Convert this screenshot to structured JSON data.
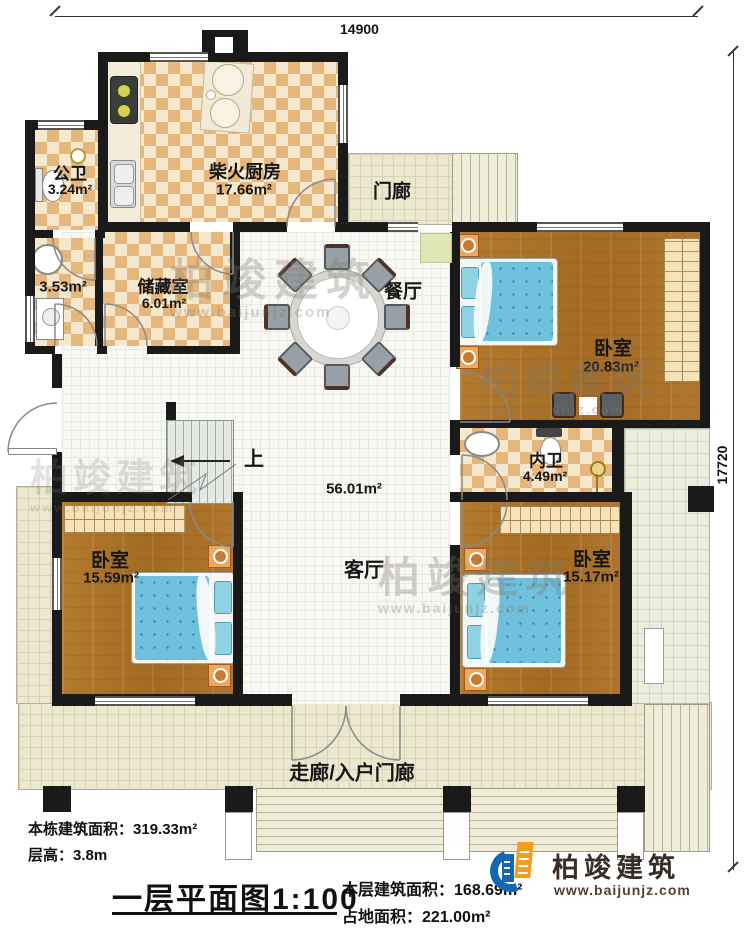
{
  "plan": {
    "dimensions": {
      "width_label": "14900",
      "height_label": "17720"
    },
    "rooms": {
      "kitchen": {
        "name": "柴火厨房",
        "area": "17.66m²"
      },
      "public_bath": {
        "name": "公卫",
        "area": "3.24m²"
      },
      "side_bath": {
        "area": "3.53m²"
      },
      "storage": {
        "name": "储藏室",
        "area": "6.01m²"
      },
      "porch": {
        "name": "门廊"
      },
      "dining": {
        "name": "餐厅"
      },
      "living": {
        "name": "客厅",
        "area": "56.01m²"
      },
      "bedroom_ne": {
        "name": "卧室",
        "area": "20.83m²"
      },
      "inner_bath": {
        "name": "内卫",
        "area": "4.49m²"
      },
      "bedroom_sw": {
        "name": "卧室",
        "area": "15.59m²"
      },
      "bedroom_se": {
        "name": "卧室",
        "area": "15.17m²"
      },
      "entry": {
        "name": "走廊/入户门廊"
      }
    },
    "stairs": {
      "up_label": "上"
    }
  },
  "footer": {
    "building_area_label": "本栋建筑面积：",
    "building_area_value": "319.33m²",
    "floor_height_label": "层高：",
    "floor_height_value": "3.8m",
    "title": "一层平面图",
    "scale": "1:100",
    "floor_area_label": "本层建筑面积：",
    "floor_area_value": "168.69m²",
    "land_area_label": "占地面积：",
    "land_area_value": "221.00m²"
  },
  "brand": {
    "name": "柏竣建筑",
    "website": "www.baijunjz.com"
  },
  "watermark": {
    "text": "柏竣建筑",
    "url": "www.baijunjz.com"
  },
  "colors": {
    "wall": "#1a1a1a",
    "checker_dark": "#e6b77c",
    "checker_light": "#f6e8cc",
    "wood": "#aa7128",
    "bed_blue": "#6fc0dd",
    "outdoor_tile": "#ece8d0",
    "logo_blue": "#1568b0",
    "logo_orange": "#f59d20"
  }
}
